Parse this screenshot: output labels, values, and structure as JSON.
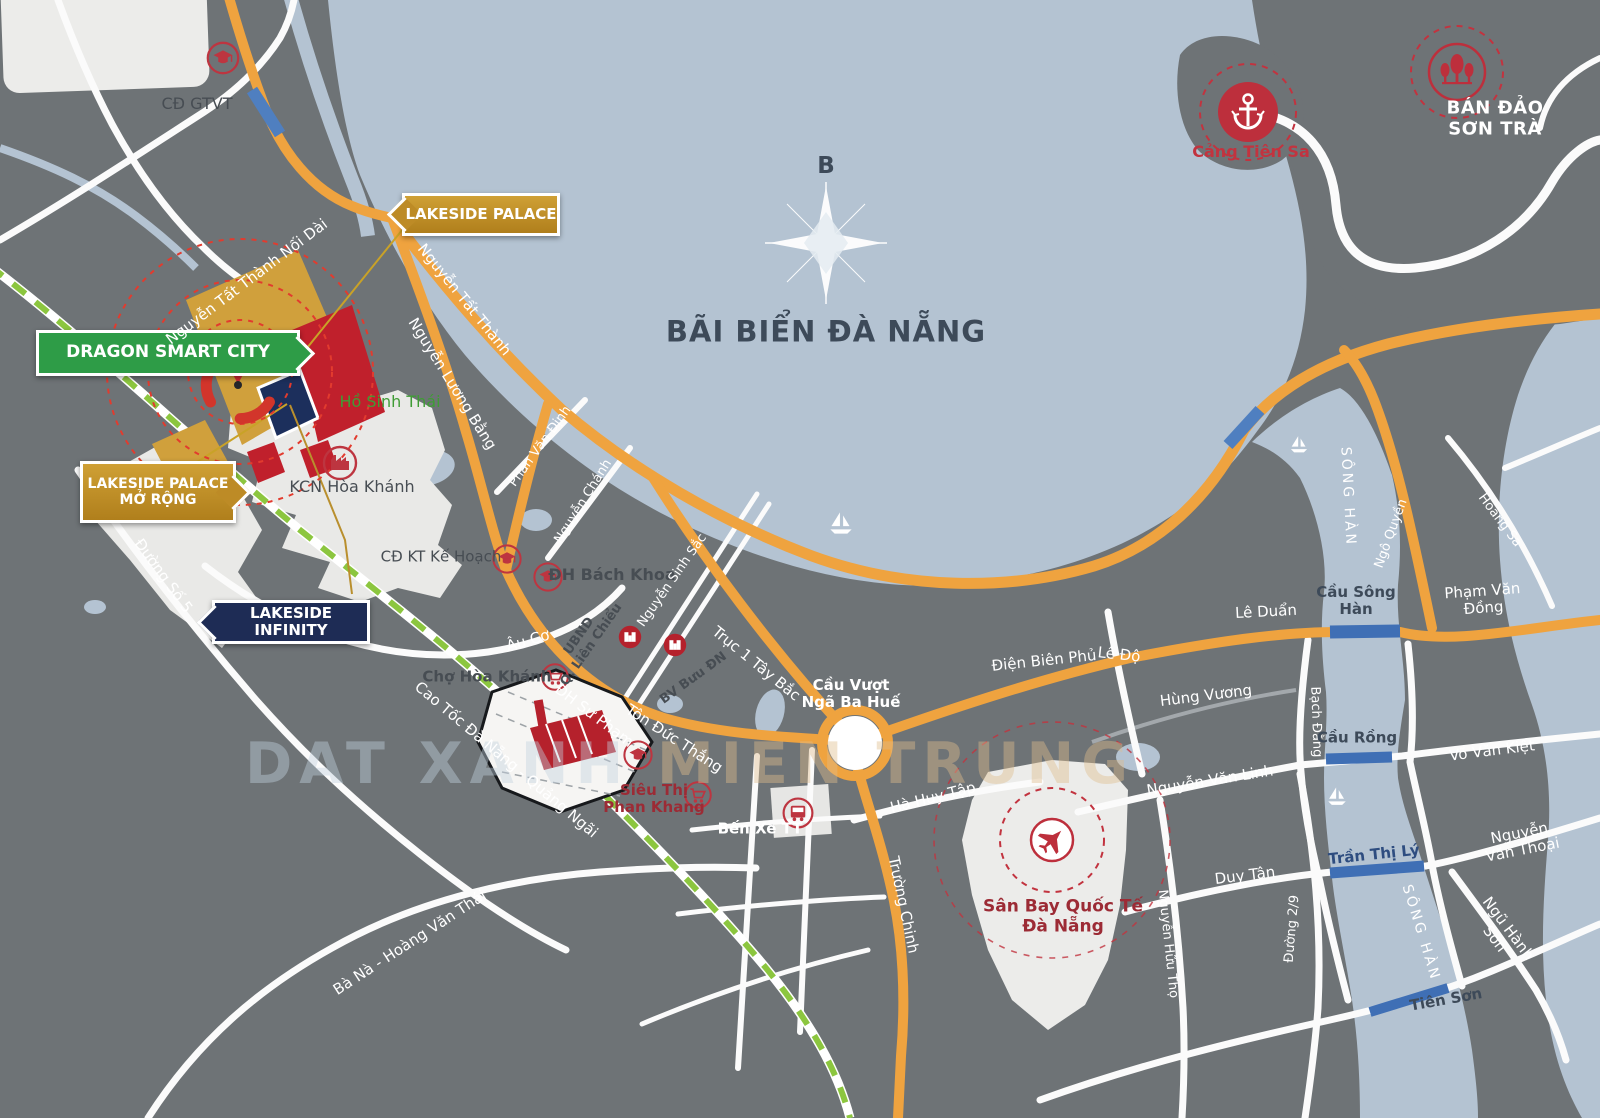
{
  "map": {
    "sea_title": "BÃI BIỂN ĐÀ NẴNG",
    "compass_label": "B",
    "watermark": {
      "part1": "DAT XANH ",
      "part2": "MIEN TRUNG"
    }
  },
  "badges": {
    "dragon": "DRAGON SMART CITY",
    "lakeside_palace": "LAKESIDE PALACE",
    "lakeside_palace_mo_rong": "LAKESIDE PALACE\nMỞ RỘNG",
    "lakeside_infinity": "LAKESIDE INFINITY"
  },
  "places": [
    {
      "text": "CĐ GTVT"
    },
    {
      "text": "Hồ Sinh Thái"
    },
    {
      "text": "KCN Hòa Khánh"
    },
    {
      "text": "CĐ KT Kế Hoạch"
    },
    {
      "text": "ĐH Bách Khoa"
    },
    {
      "text": "UBND\nQ. Liên Chiểu"
    },
    {
      "text": "BV Bưu ĐN"
    },
    {
      "text": "Chợ Hòa Khánh"
    },
    {
      "text": "Cầu Vượt\nNgã Ba Huế"
    },
    {
      "text": "Bến Xe TT"
    },
    {
      "text": "Siêu Thị\nPhan Khang"
    },
    {
      "text": "Sân Bay Quốc Tế\nĐà Nẵng"
    },
    {
      "text": "Cảng Tiên Sa"
    },
    {
      "text": "BÁN ĐẢO\nSƠN TRÀ"
    }
  ],
  "streets": [
    {
      "text": "Nguyễn Tất Thành Nối Dài"
    },
    {
      "text": "Nguyễn Tất Thành"
    },
    {
      "text": "Nguyễn Lương Bằng"
    },
    {
      "text": "Phan Văn Định"
    },
    {
      "text": "Nguyễn Chánh"
    },
    {
      "text": "Nguyễn Sinh Sắc"
    },
    {
      "text": "Trục 1 Tây Bắc"
    },
    {
      "text": "Âu Cơ"
    },
    {
      "text": "ĐH Sư Phạm"
    },
    {
      "text": "Tôn Đức Thắng"
    },
    {
      "text": "Cao Tốc Đà Nẵng - Quảng Ngãi"
    },
    {
      "text": "Bà Nà - Hoàng Văn Thái"
    },
    {
      "text": "Đường Số 5"
    },
    {
      "text": "Trường Chinh"
    },
    {
      "text": "Hà Huy Tập"
    },
    {
      "text": "Điện Biên Phủ"
    },
    {
      "text": "Lê Độ"
    },
    {
      "text": "Lê Duẩn"
    },
    {
      "text": "Hùng Vương"
    },
    {
      "text": "Bạch Đằng"
    },
    {
      "text": "Phạm Văn Đồng"
    },
    {
      "text": "Ngô Quyền"
    },
    {
      "text": "Hoàng Sa"
    },
    {
      "text": "Võ Văn Kiệt"
    },
    {
      "text": "Nguyễn Văn Linh"
    },
    {
      "text": "Duy Tân"
    },
    {
      "text": "Nguyễn Văn Thoại"
    },
    {
      "text": "Ngũ Hành Sơn"
    },
    {
      "text": "Đường 2/9"
    },
    {
      "text": "Nguyễn Hữu Thọ"
    },
    {
      "text": "Tiên Sơn"
    },
    {
      "text": "SÔNG HÀN"
    },
    {
      "text": "SÔNG HÀN"
    },
    {
      "text": "Cầu Sông\nHàn"
    },
    {
      "text": "Cầu Rồng"
    },
    {
      "text": "Trần Thị Lý"
    }
  ],
  "colors": {
    "land": "#6E7376",
    "water": "#B4C3D2",
    "main_road": "#EFA33F",
    "railway_green": "#8CC63F",
    "bridge_blue": "#3F6FB5",
    "project_gold": "#D0A03C",
    "project_red": "#C0202C",
    "project_navy": "#1C2F5C",
    "badge_green": "#2E9C47",
    "badge_gold": "#C08B26",
    "badge_navy": "#1E2C55",
    "poi_red": "#BD2F3C"
  }
}
